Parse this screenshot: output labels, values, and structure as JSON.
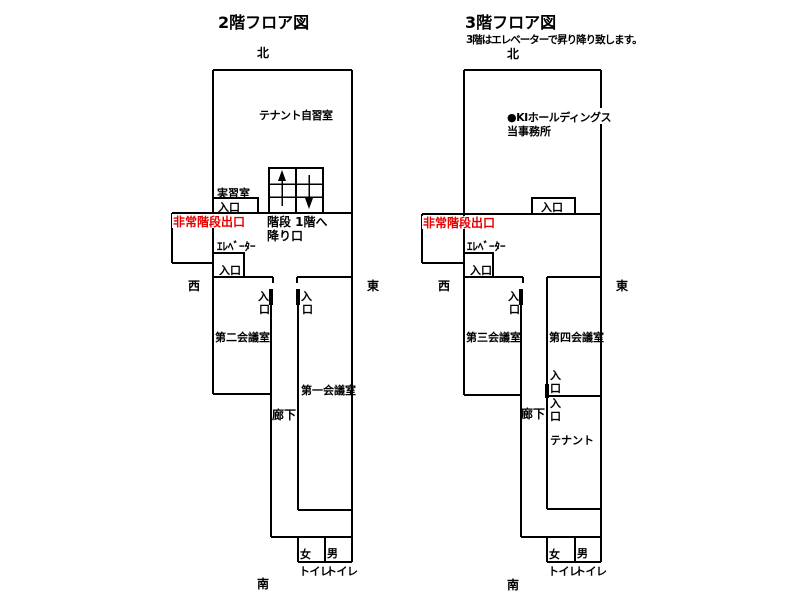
{
  "colors": {
    "wall": "#000000",
    "emergency_text": "#e60000",
    "background": "#ffffff"
  },
  "icons": {
    "stairs_up": "up-arrow",
    "stairs_down": "down-arrow"
  },
  "floor2": {
    "title": "2階フロア図",
    "north": "北",
    "south": "南",
    "west": "西",
    "east": "東",
    "tenant_study_room": "テナント自習室",
    "training_room": "実習室",
    "training_room_entrance": "入口",
    "stairs_label_line1": "階段 1階へ",
    "stairs_label_line2": "降り口",
    "emergency_exit": "非常階段出口",
    "elevator": "ｴﾚﾍﾞｰﾀｰ",
    "elevator_entrance": "入口",
    "meeting_room_2": "第二会議室",
    "meeting_room_2_entrance": [
      "入",
      "口"
    ],
    "meeting_room_1": "第一会議室",
    "meeting_room_1_entrance": [
      "入",
      "口"
    ],
    "corridor": "廊下",
    "toilet_women": "女",
    "toilet_men": "男",
    "toilet_label_left": "トイレ",
    "toilet_label_right": "トイレ"
  },
  "floor3": {
    "title": "3階フロア図",
    "note": "3階はエレベーターで昇り降り致します。",
    "north": "北",
    "south": "南",
    "west": "西",
    "east": "東",
    "office_line1": "●KIホールディングス",
    "office_line2": "当事務所",
    "office_entrance": "入口",
    "emergency_exit": "非常階段出口",
    "elevator": "ｴﾚﾍﾞｰﾀｰ",
    "elevator_entrance": "入口",
    "meeting_room_3": "第三会議室",
    "meeting_room_3_entrance": [
      "入",
      "口"
    ],
    "meeting_room_4": "第四会議室",
    "meeting_room_4_entrance": [
      "入",
      "口"
    ],
    "tenant_room": "テナント",
    "tenant_entrance": [
      "入",
      "口"
    ],
    "corridor": "廊下",
    "toilet_women": "女",
    "toilet_men": "男",
    "toilet_label_left": "トイレ",
    "toilet_label_right": "トイレ"
  }
}
